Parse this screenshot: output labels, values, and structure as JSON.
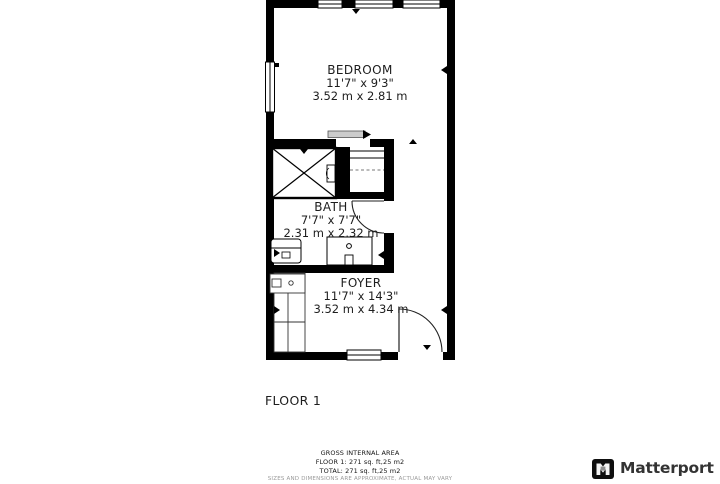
{
  "plan": {
    "rooms": [
      {
        "name": "BEDROOM",
        "imperial": "11'7\" x 9'3\"",
        "metric": "3.52 m x 2.81 m"
      },
      {
        "name": "BATH",
        "imperial": "7'7\" x 7'7\"",
        "metric": "2.31 m x 2.32 m"
      },
      {
        "name": "FOYER",
        "imperial": "11'7\" x 14'3\"",
        "metric": "3.52 m x 4.34 m"
      }
    ],
    "floor_label": "FLOOR 1"
  },
  "footer": {
    "title": "GROSS INTERNAL AREA",
    "floor_area": "FLOOR 1: 271 sq. ft,25 m2",
    "total_area": "TOTAL: 271 sq. ft,25 m2",
    "disclaimer": "SIZES AND DIMENSIONS ARE APPROXIMATE, ACTUAL MAY VARY"
  },
  "branding": {
    "name": "Matterport",
    "icon": "matterport-logo-icon"
  },
  "colors": {
    "wall": "#000000",
    "label_text": "#1d1d1d",
    "slider_gray": "#cccccc",
    "footer_muted": "#9a9a9a",
    "brand_text": "#333333"
  }
}
